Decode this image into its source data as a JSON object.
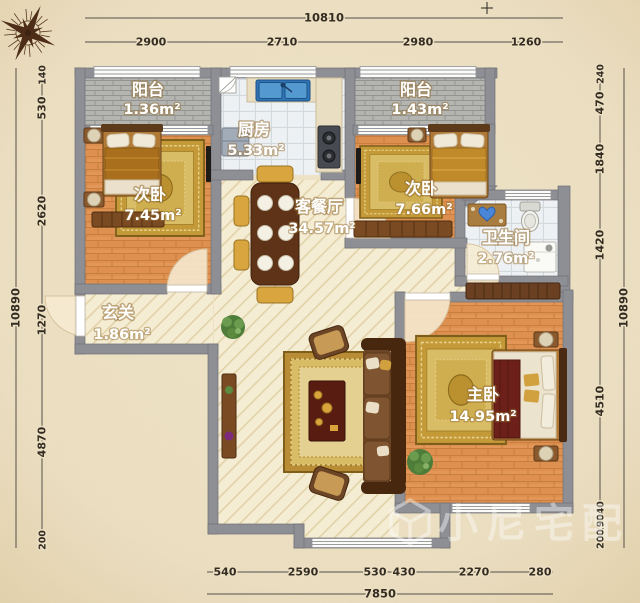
{
  "plan": {
    "watermark": "小尼宅配",
    "compass_icon": "compass-rose"
  },
  "dims": {
    "top": {
      "total": "10810",
      "segments": [
        "2900",
        "2710",
        "2980",
        "1260"
      ]
    },
    "bottom": {
      "total": "7850",
      "segments": [
        "540",
        "2590",
        "530",
        "430",
        "2270",
        "280"
      ]
    },
    "left": {
      "total": "10890",
      "segments": [
        "140",
        "530",
        "2620",
        "1270",
        "4870",
        "200"
      ]
    },
    "right": {
      "total": "10890",
      "segments": [
        "240",
        "470",
        "1840",
        "1420",
        "4510",
        "240",
        "290",
        "200"
      ]
    }
  },
  "rooms": {
    "balcony_left": {
      "name": "阳台",
      "area": "1.36m²"
    },
    "kitchen": {
      "name": "厨房",
      "area": "5.33m²"
    },
    "balcony_right": {
      "name": "阳台",
      "area": "1.43m²"
    },
    "bedroom_left": {
      "name": "次卧",
      "area": "7.45m²"
    },
    "bedroom_right": {
      "name": "次卧",
      "area": "7.66m²"
    },
    "bathroom": {
      "name": "卫生间",
      "area": "2.76m²"
    },
    "entry": {
      "name": "玄关",
      "area": "1.86m²"
    },
    "living_dining": {
      "name": "客餐厅",
      "area": "34.57m²"
    },
    "master_bedroom": {
      "name": "主卧",
      "area": "14.95m²"
    }
  },
  "palette": {
    "background": "#ecdfc2",
    "wall": "#8e8f94",
    "wood_floor": "#dd9050",
    "tile_floor": "#eef1f3",
    "living_floor": "#f4ecd3",
    "balcony_floor": "#b4b5b1",
    "rug_gold": "#c49a38",
    "sink_blue": "#2f74b5",
    "label_text": "#ffffff",
    "dim_text": "#332c22"
  }
}
